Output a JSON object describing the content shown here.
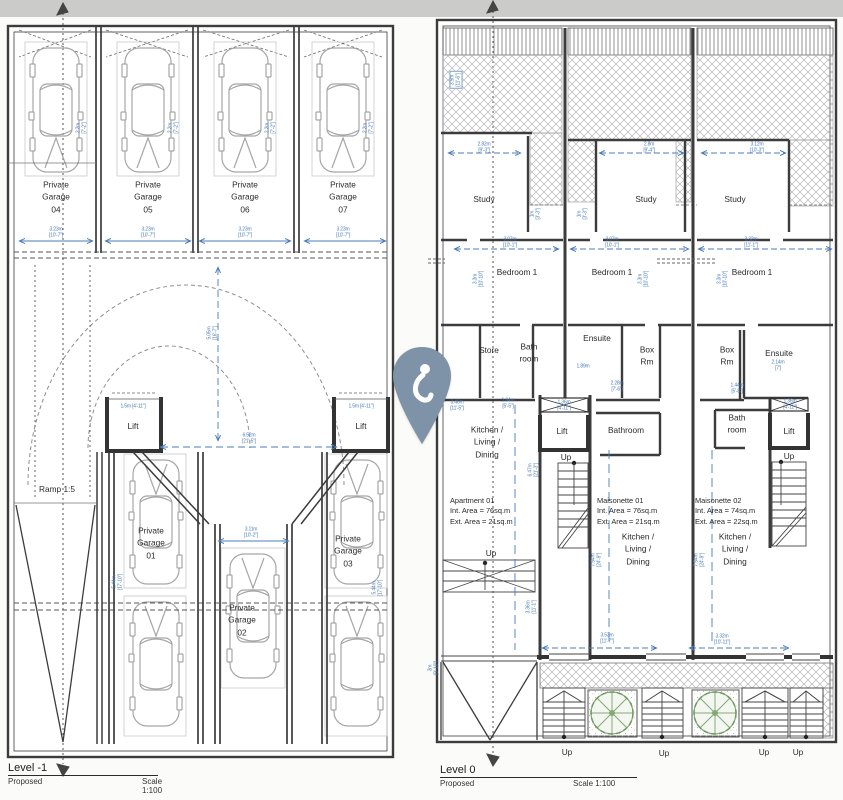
{
  "page": {
    "background": "#fbfbf9",
    "top_band_color": "#cbcbc9"
  },
  "colors": {
    "wall": "#3c3c3c",
    "dim_blue": "#4a7db8",
    "hatch_gray": "#b4b4b4",
    "car_gray": "#a6a6a6",
    "plant_green": "#85a877",
    "pin": "#7e93a7"
  },
  "icons": {
    "pin": "location-pin-icon",
    "north_left": "north-arrow-icon",
    "north_right": "north-arrow-icon"
  },
  "level_minus1": {
    "title": "Level -1",
    "status_label": "Proposed",
    "scale_label": "Scale 1:100",
    "labels": [
      {
        "t": "Private\nGarage\n04",
        "x": 56,
        "y": 197
      },
      {
        "t": "Private\nGarage\n05",
        "x": 148,
        "y": 197
      },
      {
        "t": "Private\nGarage\n06",
        "x": 245,
        "y": 197
      },
      {
        "t": "Private\nGarage\n07",
        "x": 343,
        "y": 197
      },
      {
        "t": "Lift",
        "x": 133,
        "y": 426
      },
      {
        "t": "Lift",
        "x": 361,
        "y": 426
      },
      {
        "t": "Ramp 1:5",
        "x": 57,
        "y": 489
      },
      {
        "t": "Private\nGarage\n01",
        "x": 151,
        "y": 543
      },
      {
        "t": "Private\nGarage\n02",
        "x": 242,
        "y": 620
      },
      {
        "t": "Private\nGarage\n03",
        "x": 348,
        "y": 551
      }
    ],
    "dims": [
      {
        "t": "3.23m\n[10'-7\"]",
        "x": 56,
        "y": 233
      },
      {
        "t": "3.23m\n[10'-7\"]",
        "x": 148,
        "y": 233
      },
      {
        "t": "3.23m\n[10'-7\"]",
        "x": 245,
        "y": 233
      },
      {
        "t": "3.23m\n[10'-7\"]",
        "x": 343,
        "y": 233
      },
      {
        "t": "2.2m\n[7'-2\"]",
        "x": 82,
        "y": 128,
        "rot": 90
      },
      {
        "t": "2.2m\n[7'-2\"]",
        "x": 174,
        "y": 128,
        "rot": 90
      },
      {
        "t": "2.2m\n[7'-2\"]",
        "x": 271,
        "y": 128,
        "rot": 90
      },
      {
        "t": "2.2m\n[7'-2\"]",
        "x": 369,
        "y": 128,
        "rot": 90
      },
      {
        "t": "1.5m [4'-11\"]",
        "x": 133,
        "y": 407
      },
      {
        "t": "1.5m [4'-11\"]",
        "x": 361,
        "y": 407
      },
      {
        "t": "6.52m\n[21'-5\"]",
        "x": 249,
        "y": 439
      },
      {
        "t": "5.05m\n[16'-7\"]",
        "x": 213,
        "y": 333,
        "rot": 90
      },
      {
        "t": "3.11m\n[10'-2\"]",
        "x": 251,
        "y": 533
      },
      {
        "t": "5.44m\n[17'-10\"]",
        "x": 118,
        "y": 582,
        "rot": 90
      },
      {
        "t": "5.44m\n[17'-10\"]",
        "x": 378,
        "y": 588,
        "rot": 90
      }
    ]
  },
  "level_0": {
    "title": "Level 0",
    "status_label": "Proposed",
    "scale_label": "Scale 1:100",
    "labels": [
      {
        "t": "Study",
        "x": 484,
        "y": 199
      },
      {
        "t": "Study",
        "x": 646,
        "y": 199
      },
      {
        "t": "Study",
        "x": 735,
        "y": 199
      },
      {
        "t": "Bedroom 1",
        "x": 517,
        "y": 272
      },
      {
        "t": "Bedroom 1",
        "x": 612,
        "y": 272
      },
      {
        "t": "Bedroom 1",
        "x": 752,
        "y": 272
      },
      {
        "t": "Store",
        "x": 489,
        "y": 350
      },
      {
        "t": "Bath\nroom",
        "x": 529,
        "y": 353
      },
      {
        "t": "Ensuite",
        "x": 597,
        "y": 338
      },
      {
        "t": "Box\nRm",
        "x": 647,
        "y": 356
      },
      {
        "t": "Box\nRm",
        "x": 727,
        "y": 356
      },
      {
        "t": "Ensuite",
        "x": 779,
        "y": 353
      },
      {
        "t": "Kitchen /\nLiving /\nDining",
        "x": 487,
        "y": 442
      },
      {
        "t": "Lift",
        "x": 562,
        "y": 431
      },
      {
        "t": "Bathroom",
        "x": 626,
        "y": 430
      },
      {
        "t": "Bath\nroom",
        "x": 737,
        "y": 424
      },
      {
        "t": "Lift",
        "x": 789,
        "y": 431
      },
      {
        "t": "Up",
        "x": 566,
        "y": 457
      },
      {
        "t": "Up",
        "x": 789,
        "y": 456
      },
      {
        "t": "Apartment 01\nInt. Area  = 76sq.m\nExt. Area = 21sq.m",
        "x": 450,
        "y": 496,
        "k": "info"
      },
      {
        "t": "Maisonette 01\nInt. Area  = 76sq.m\nExt. Area = 21sq.m",
        "x": 597,
        "y": 496,
        "k": "info"
      },
      {
        "t": "Maisonette 02\nInt. Area  = 74sq.m\nExt. Area = 22sq.m",
        "x": 695,
        "y": 496,
        "k": "info"
      },
      {
        "t": "Kitchen /\nLiving /\nDining",
        "x": 638,
        "y": 549
      },
      {
        "t": "Kitchen /\nLiving /\nDining",
        "x": 735,
        "y": 549
      },
      {
        "t": "Up",
        "x": 491,
        "y": 553
      },
      {
        "t": "Up",
        "x": 567,
        "y": 752
      },
      {
        "t": "Up",
        "x": 664,
        "y": 753
      },
      {
        "t": "Up",
        "x": 764,
        "y": 752
      },
      {
        "t": "Up",
        "x": 798,
        "y": 752
      }
    ],
    "dims": [
      {
        "t": "3.5m\n[11'-6\"]",
        "x": 456,
        "y": 80,
        "rot": 90,
        "boxed": true
      },
      {
        "t": "2.82m\n[9'-3\"]",
        "x": 484,
        "y": 148
      },
      {
        "t": "2.8m\n[9'-4\"]",
        "x": 649,
        "y": 148
      },
      {
        "t": "3.12m\n[10'-3\"]",
        "x": 757,
        "y": 148
      },
      {
        "t": "1m\n[3'-3\"]",
        "x": 536,
        "y": 214,
        "rot": 90
      },
      {
        "t": "1m\n[3'-3\"]",
        "x": 583,
        "y": 214,
        "rot": 90
      },
      {
        "t": "3.07m\n[10'-1\"]",
        "x": 510,
        "y": 243
      },
      {
        "t": "3.07m\n[10'-1\"]",
        "x": 612,
        "y": 243
      },
      {
        "t": "3.32m\n[11'-1\"]",
        "x": 751,
        "y": 243
      },
      {
        "t": "3.3m\n[10'-10\"]",
        "x": 479,
        "y": 279,
        "rot": 90
      },
      {
        "t": "3.3m\n[10'-10\"]",
        "x": 644,
        "y": 279,
        "rot": 90
      },
      {
        "t": "3.3m\n[10'-10\"]",
        "x": 723,
        "y": 279,
        "rot": 90
      },
      {
        "t": "1.64m\n[5'-5\"]",
        "x": 508,
        "y": 404
      },
      {
        "t": "1.89m",
        "x": 583,
        "y": 367
      },
      {
        "t": "2.28m\n[7'-6\"]",
        "x": 617,
        "y": 387
      },
      {
        "t": "2.14m\n[7']",
        "x": 778,
        "y": 366
      },
      {
        "t": "1.44m\n[5'-8\"]",
        "x": 737,
        "y": 389
      },
      {
        "t": "3.46m\n[11'-5\"]",
        "x": 457,
        "y": 406
      },
      {
        "t": "1.36m\n[4'-11\"]",
        "x": 564,
        "y": 406
      },
      {
        "t": "1.36m\n[4'-11\"]",
        "x": 790,
        "y": 405
      },
      {
        "t": "6.47m\n[21'-3\"]",
        "x": 534,
        "y": 470,
        "rot": 90
      },
      {
        "t": "7.54m\n[24'-9\"]",
        "x": 597,
        "y": 560,
        "rot": 90
      },
      {
        "t": "7.54m\n[24'-9\"]",
        "x": 700,
        "y": 560,
        "rot": 90
      },
      {
        "t": "3.36m\n[11'-1\"]",
        "x": 532,
        "y": 607,
        "rot": 90
      },
      {
        "t": "3.53m\n[11'-7\"]",
        "x": 607,
        "y": 639
      },
      {
        "t": "3.32m\n[10'-11\"]",
        "x": 722,
        "y": 640
      },
      {
        "t": "3m\n[9'-10\"]",
        "x": 434,
        "y": 668,
        "rot": 90
      }
    ]
  }
}
